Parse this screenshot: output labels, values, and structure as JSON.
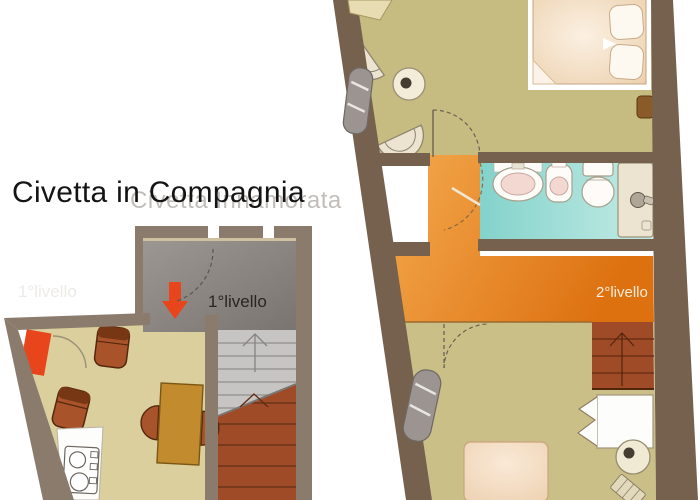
{
  "title": {
    "text": "Civetta in Compagnia",
    "watermark": "Civetta Innamorata"
  },
  "plans": {
    "level1": {
      "label": "1°livello",
      "watermark": "1°livello"
    },
    "level2": {
      "label": "2°livello"
    }
  },
  "colors": {
    "wall_level1": "#8b7b6c",
    "wall_level2": "#76614e",
    "floor_level1": "#dbcf9d",
    "floor_level2_upper": "#c6bb80",
    "floor_level2_lower": "#cabf87",
    "entry_gray": "#8f8985",
    "corridor_orange": "#e8821f",
    "bathroom_teal": "#93d8d1",
    "stairs_terracotta": "#a04b27",
    "stairs_gray": "#c7c5c3",
    "accent_red": "#e8451c",
    "table_brown": "#c28b2e",
    "chair_brown": "#a9532b",
    "bed_peach": "#f4dcc2",
    "fixture_beige": "#ece4d0",
    "label_dark": "#2a2522",
    "label_light": "#f7ecd9"
  }
}
